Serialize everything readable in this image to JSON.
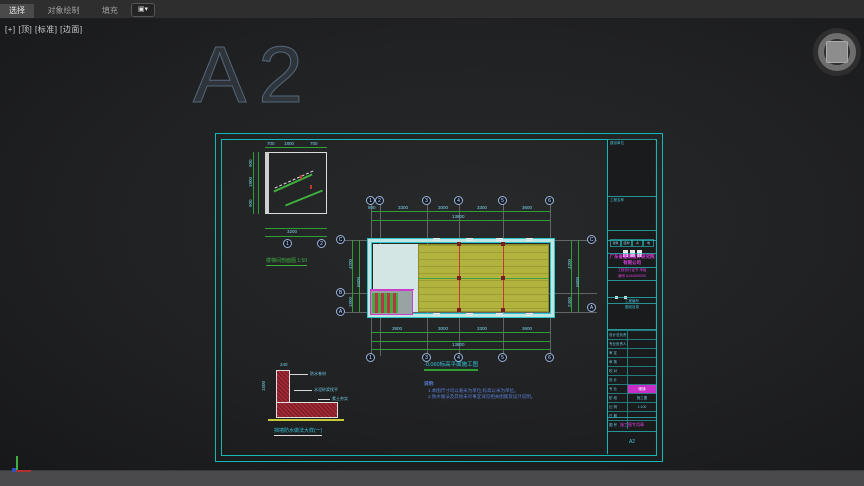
{
  "toolbar": {
    "tabs": [
      {
        "label": "选择",
        "active": true
      },
      {
        "label": "对象绘制",
        "active": false
      },
      {
        "label": "填充",
        "active": false
      }
    ],
    "dropdown_icon": "▣▾"
  },
  "viewport": {
    "label": "[+] [顶] [标准] [边面]",
    "big_text": "A2"
  },
  "plan": {
    "caption": "-0.060标高平面施工图",
    "grid_top": [
      "1",
      "2",
      "3",
      "4",
      "5",
      "6"
    ],
    "grid_bottom": [
      "1",
      "3",
      "4",
      "5",
      "6"
    ],
    "grid_left": [
      "C",
      "B",
      "A"
    ],
    "grid_right": [
      "C",
      "A"
    ],
    "dims_top": [
      "600",
      "3300",
      "3000",
      "3300",
      "3600"
    ],
    "dims_top_total": "13800",
    "dims_bottom": [
      "3900",
      "3000",
      "3300",
      "3600"
    ],
    "dims_bottom_total": "13800",
    "dims_left": [
      "4200",
      "1800"
    ],
    "dims_left_total": "6600",
    "dims_right": [
      "4200",
      "2400"
    ],
    "dims_right_total": "6600"
  },
  "stair_detail": {
    "caption": "楼梯间剖面图 1:50",
    "dims_top": [
      "700",
      "1800",
      "700"
    ],
    "dims_left": [
      "900",
      "1800",
      "900"
    ],
    "dim_total": "3200",
    "bubbles": [
      "1",
      "2"
    ]
  },
  "corner_detail": {
    "caption": "挡墙防水做法大样(一)",
    "labels": [
      "防水卷材",
      "水泥砂浆找平",
      "素土夯实"
    ],
    "dim_top": "240",
    "dim_left": "1500"
  },
  "notes": {
    "title": "说明:",
    "lines": [
      "1.本图尺寸均以毫米为单位,标高以米为单位。",
      "2.防水做法及其他未尽事宜详见相关图集及设计说明。"
    ]
  },
  "titleblock": {
    "cell1_label": "建设单位",
    "cell2_label": "工程名称",
    "sign_labels": [
      "建筑",
      "结构",
      "水",
      "电"
    ],
    "company": "广东省建筑设计研究院\n有限公司",
    "cert": "工程设计证书 甲级\n编号 A144000000",
    "strip_label": "工程编号",
    "list_label": "图纸目录",
    "rows": [
      {
        "label": "设计总负责"
      },
      {
        "label": "专业负责人"
      },
      {
        "label": "审 定"
      },
      {
        "label": "审 核"
      },
      {
        "label": "校 对"
      },
      {
        "label": "设 计"
      },
      {
        "label": "专 业",
        "value": "暖通",
        "highlight": true
      },
      {
        "label": "阶 段",
        "value": "施工图"
      },
      {
        "label": "比 例",
        "value": "1:100"
      },
      {
        "label": "日 期"
      },
      {
        "label": "图 号"
      }
    ],
    "stamp": "施工图专用章",
    "sheet_size": "A2"
  },
  "colors": {
    "accent_cyan": "#2cc8c8",
    "hatch_yellow": "#b2b23e",
    "dim_green": "#2f9e35",
    "magenta": "#e040e0",
    "section_red": "#a22835"
  }
}
